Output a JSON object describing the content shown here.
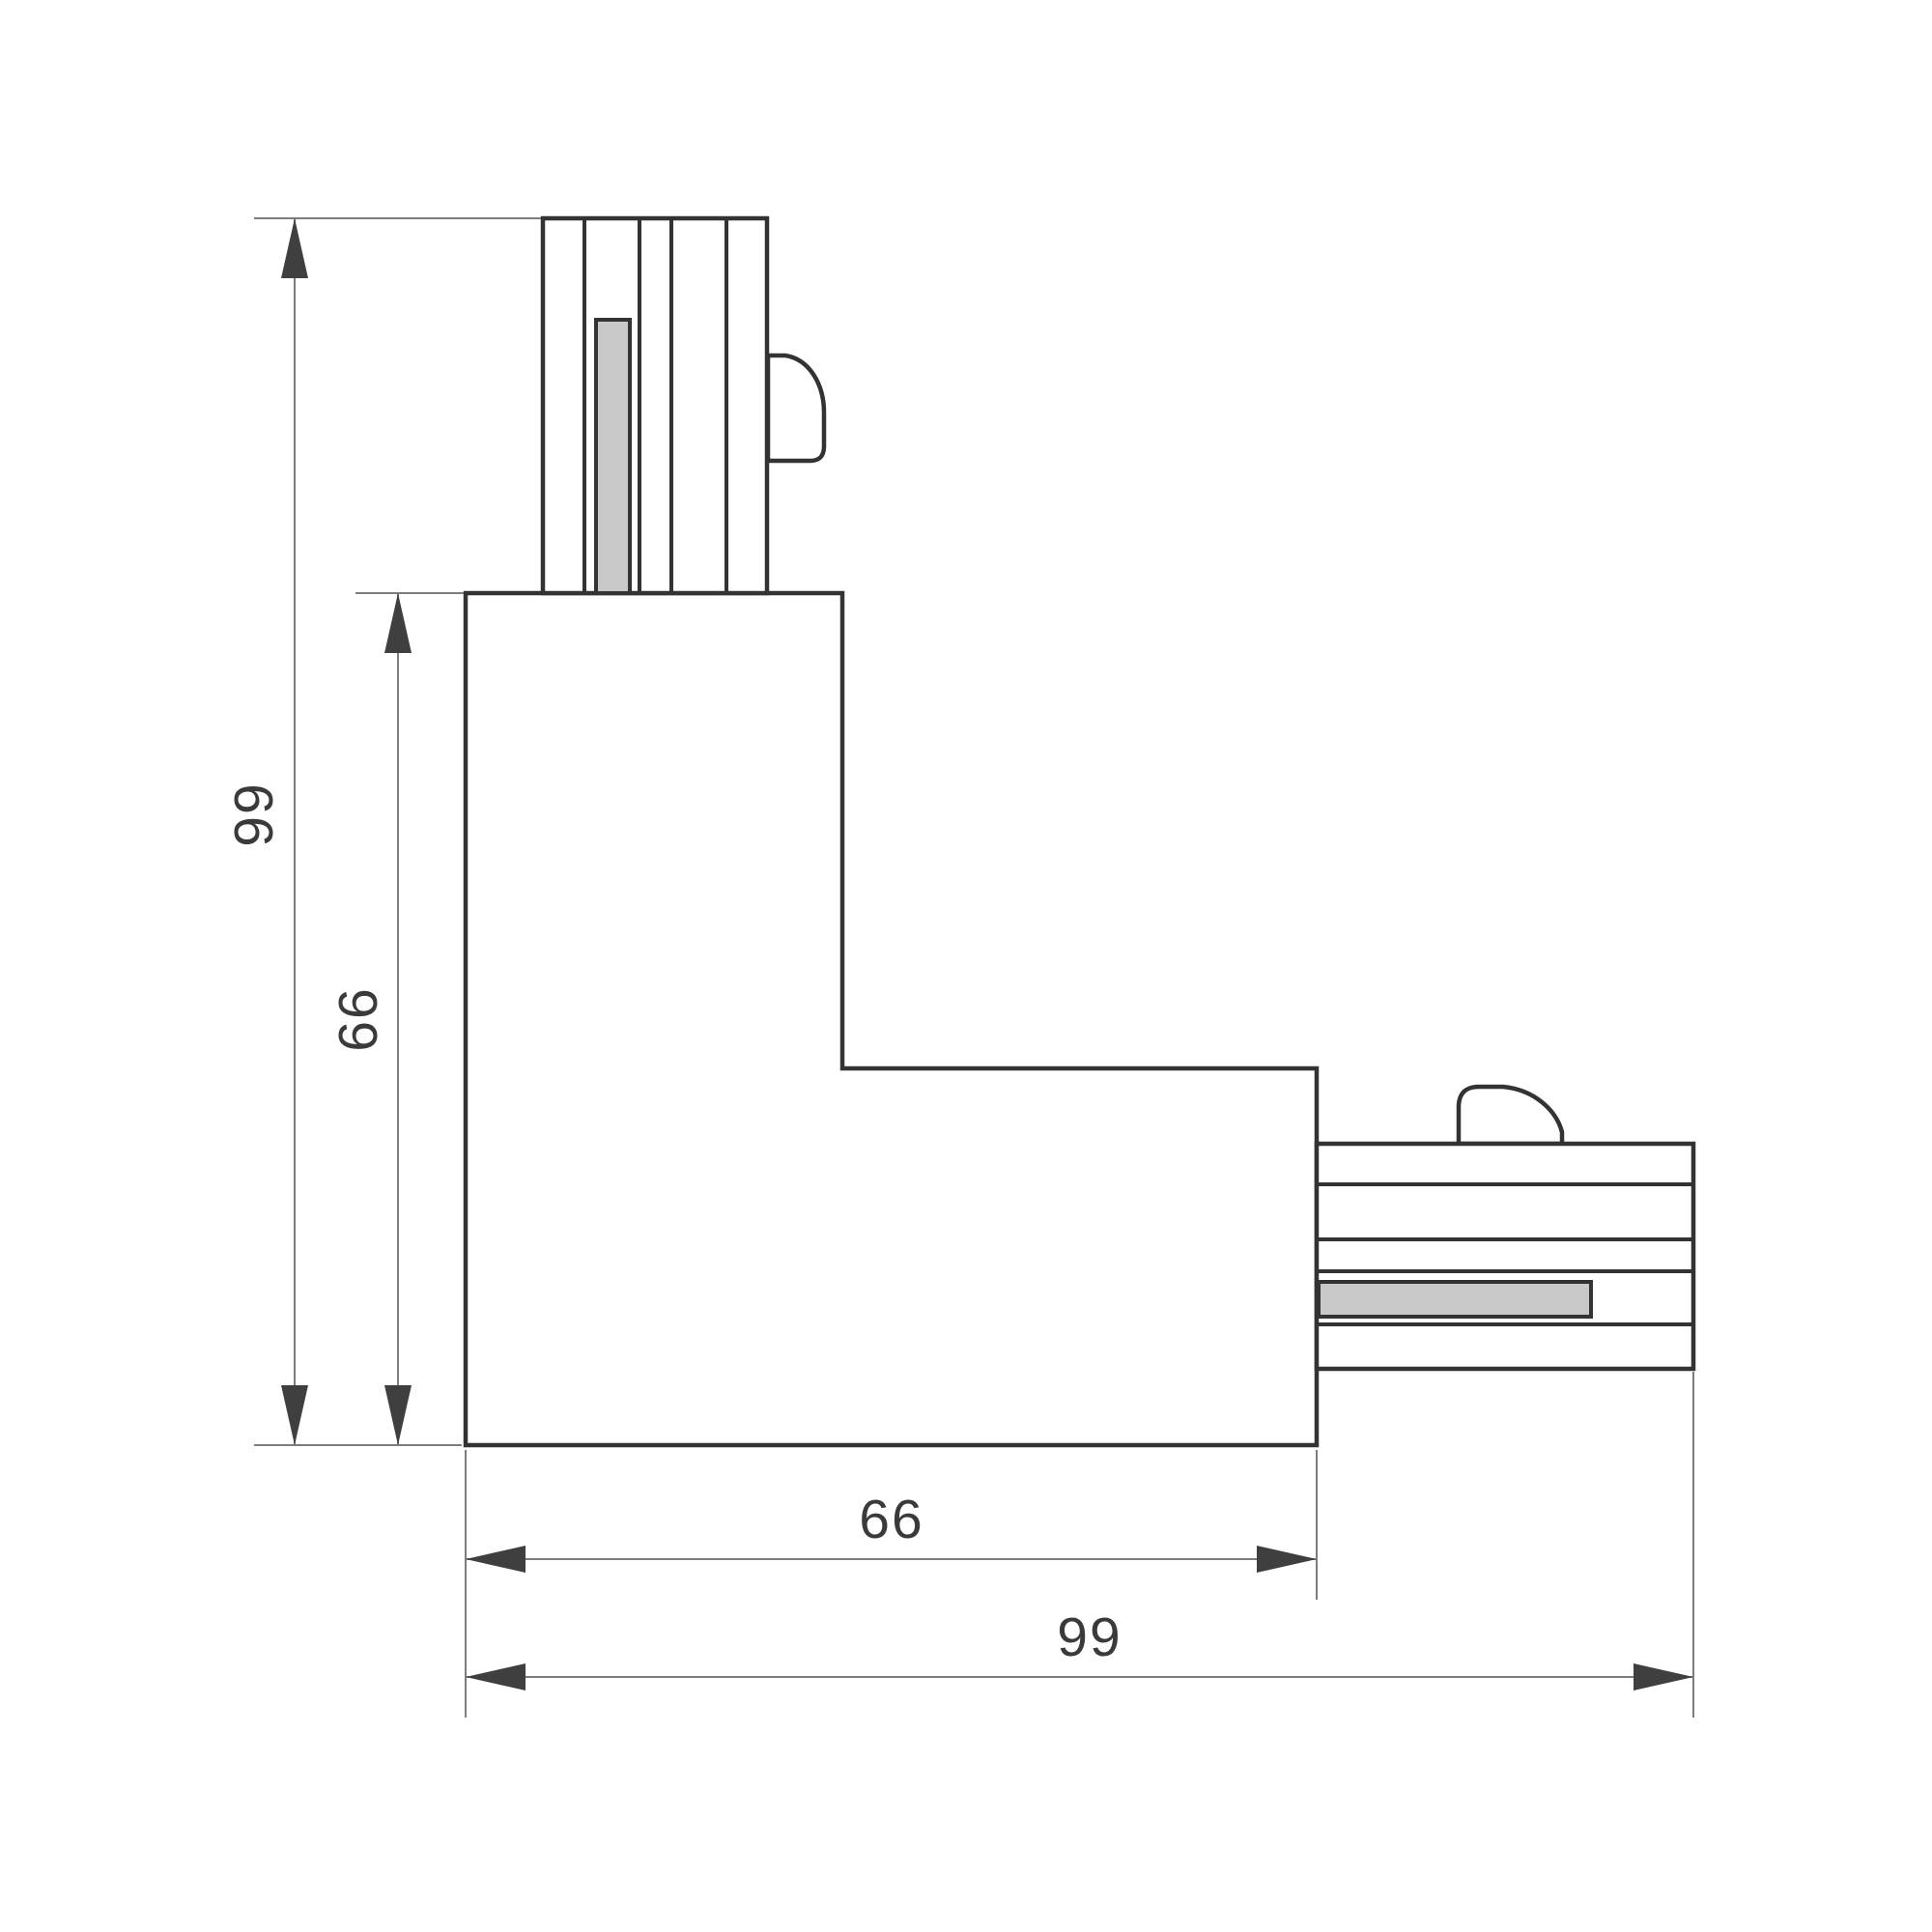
{
  "drawing": {
    "dimensions": {
      "overall_height": "99",
      "inner_height": "66",
      "inner_width": "66",
      "overall_width": "99"
    },
    "colors": {
      "background": "#ffffff",
      "outline": "#333333",
      "contact_fill": "#c8c8c8",
      "dim_line": "#7d7d7d",
      "arrow": "#3f3f3f",
      "label": "#3a3a3a"
    }
  }
}
